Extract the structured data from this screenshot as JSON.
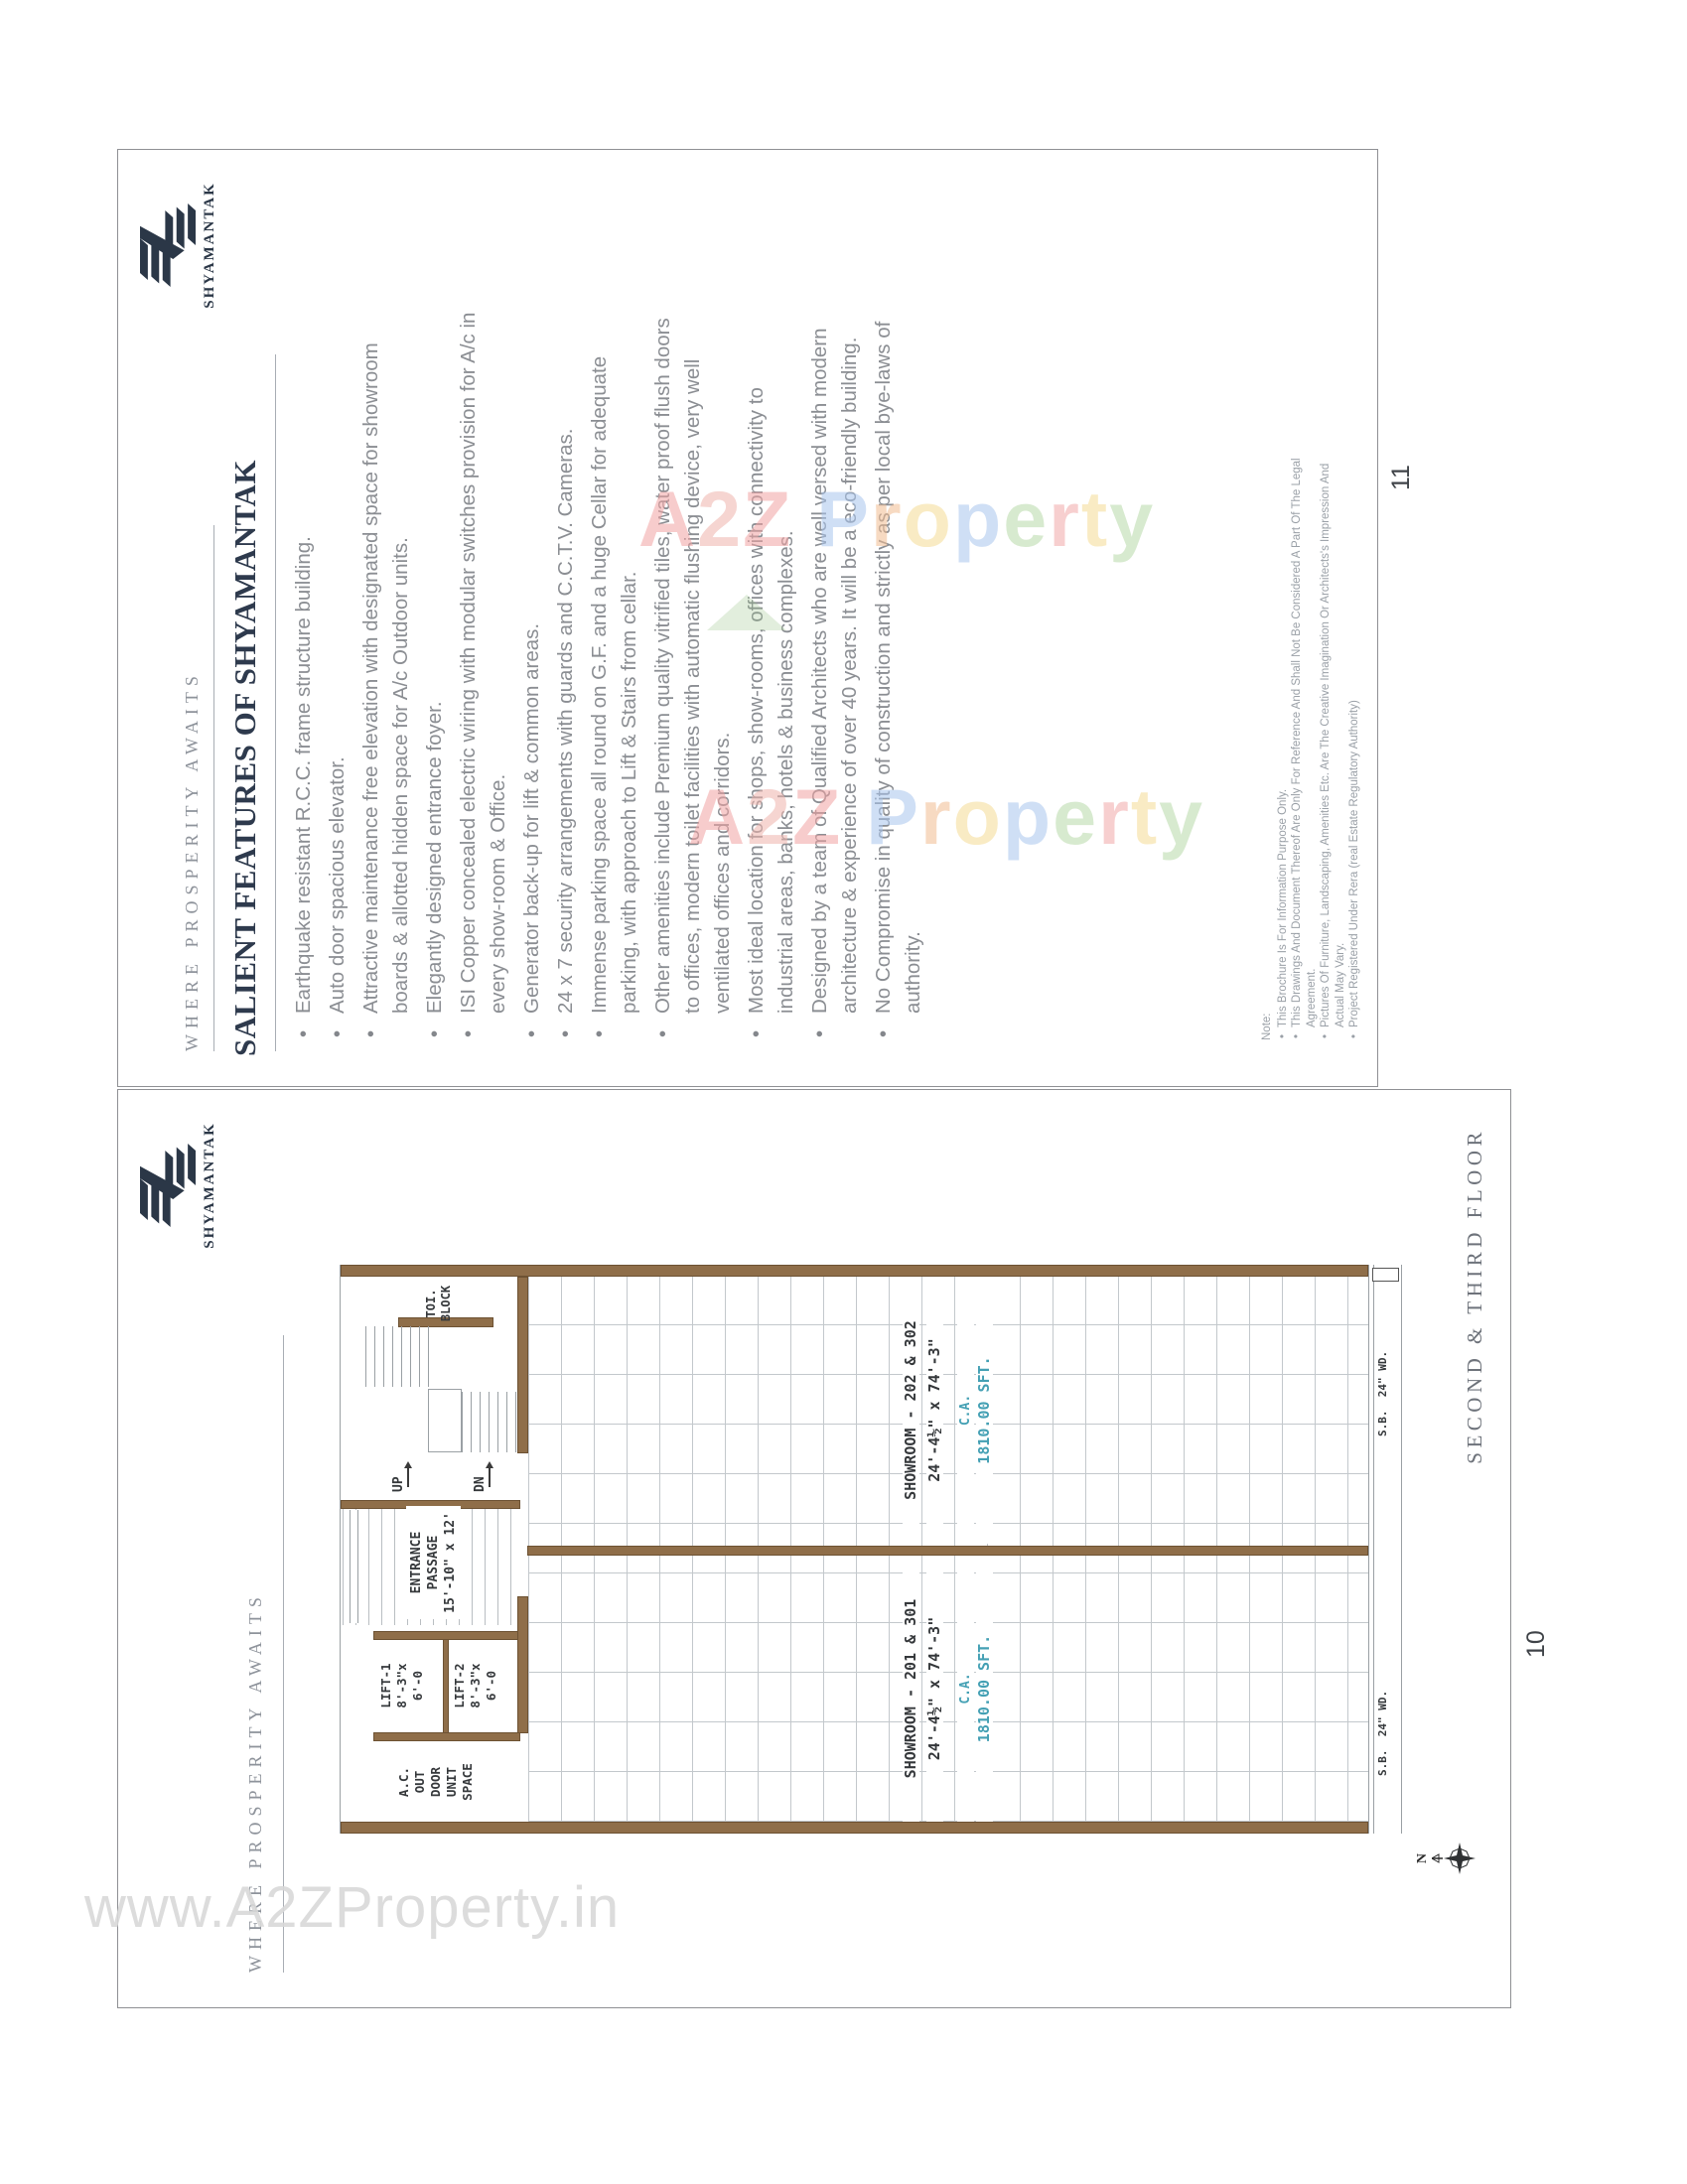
{
  "brand": {
    "tagline": "WHERE PROSPERITY AWAITS",
    "name": "SHYAMANTAK"
  },
  "colors": {
    "logo_navy": "#2b3747",
    "wall_brown": "#8f6e49",
    "area_teal": "#44a0b4"
  },
  "page11": {
    "page_number": "11",
    "title": "SALIENT FEATURES OF SHYAMANTAK",
    "bullets": [
      "Earthquake resistant R.C.C. frame structure building.",
      "Auto door spacious elevator.",
      "Attractive maintenance free elevation with designated space for showroom boards & allotted hidden space for A/c Outdoor units.",
      "Elegantly designed entrance foyer.",
      "ISI Copper concealed electric wiring with modular switches provision for A/c in every show-room & Office.",
      "Generator back-up for lift & common areas.",
      "24 x 7 security arrangements with guards and C.C.T.V. Cameras.",
      "Immense parking space all round on G.F. and a huge Cellar for adequate parking, with approach to Lift & Stairs from cellar.",
      "Other amenities include Premium quality vitrified tiles, water proof flush doors to offices,  modern toilet facilities with automatic flushing device, very well ventilated offices and corridors.",
      "Most ideal location for shops, show-rooms, offices with connectivity to industrial areas, banks, hotels & business complexes.",
      "Designed by a team of Qualified Architects who are well versed with modern architecture & experience of over 40 years. It will be a eco-friendly building.",
      "No Compromise in quality of construction and strictly as per local bye-laws of authority."
    ],
    "note": {
      "label": "Note:",
      "items": [
        "This Brochure Is For Information Purpose Only.",
        "This Drawings And Document Thereof Are Only For Reference And Shall Not Be Considered A Part Of The Legal Agreement.",
        "Pictures Of Furniture, Landscaping, Amenities Etc. Are The Creative Imagination Or Architects's Impression And Actual May Vary.",
        "Project Registered Under Rera (real Estate Regulatory Authority)"
      ]
    }
  },
  "page10": {
    "page_number": "10",
    "caption": "SECOND & THIRD FLOOR",
    "plan": {
      "toilet": [
        "TOI.",
        "BLOCK"
      ],
      "up": "UP",
      "dn": "DN",
      "entrance": [
        "ENTRANCE",
        "PASSAGE",
        "15'-10\" x 12'"
      ],
      "lift1": [
        "LIFT-1",
        "8'-3\"x",
        "6'-0"
      ],
      "lift2": [
        "LIFT-2",
        "8'-3\"x",
        "6'-0"
      ],
      "ac": [
        "A.C.",
        "OUT",
        "DOOR",
        "UNIT",
        "SPACE"
      ],
      "showroom_right": {
        "name": "SHOWROOM - 202 & 302",
        "dims": "24'-4½\" x 74'-3\"",
        "ca": "C.A.",
        "area": "1810.00 SFT."
      },
      "showroom_left": {
        "name": "SHOWROOM - 201 & 301",
        "dims": "24'-4½\" x 74'-3\"",
        "ca": "C.A.",
        "area": "1810.00 SFT."
      },
      "sb": "S.B.  24\" WD.",
      "north": "N"
    }
  },
  "watermarks": {
    "bottom": "www.A2ZProperty.in",
    "letters": [
      {
        "t": "A",
        "c": "#f2a3a3"
      },
      {
        "t": "2",
        "c": "#efb3ac"
      },
      {
        "t": "Z",
        "c": "#f2a3a3"
      },
      {
        "t": " ",
        "c": ""
      },
      {
        "t": "P",
        "c": "#a9c6ee"
      },
      {
        "t": "r",
        "c": "#f2bd92"
      },
      {
        "t": "o",
        "c": "#f5dc94"
      },
      {
        "t": "p",
        "c": "#a9c6ee"
      },
      {
        "t": "e",
        "c": "#b8d9a8"
      },
      {
        "t": "r",
        "c": "#f2a9a9"
      },
      {
        "t": "t",
        "c": "#f5dc94"
      },
      {
        "t": "y",
        "c": "#b8d9a8"
      }
    ]
  }
}
